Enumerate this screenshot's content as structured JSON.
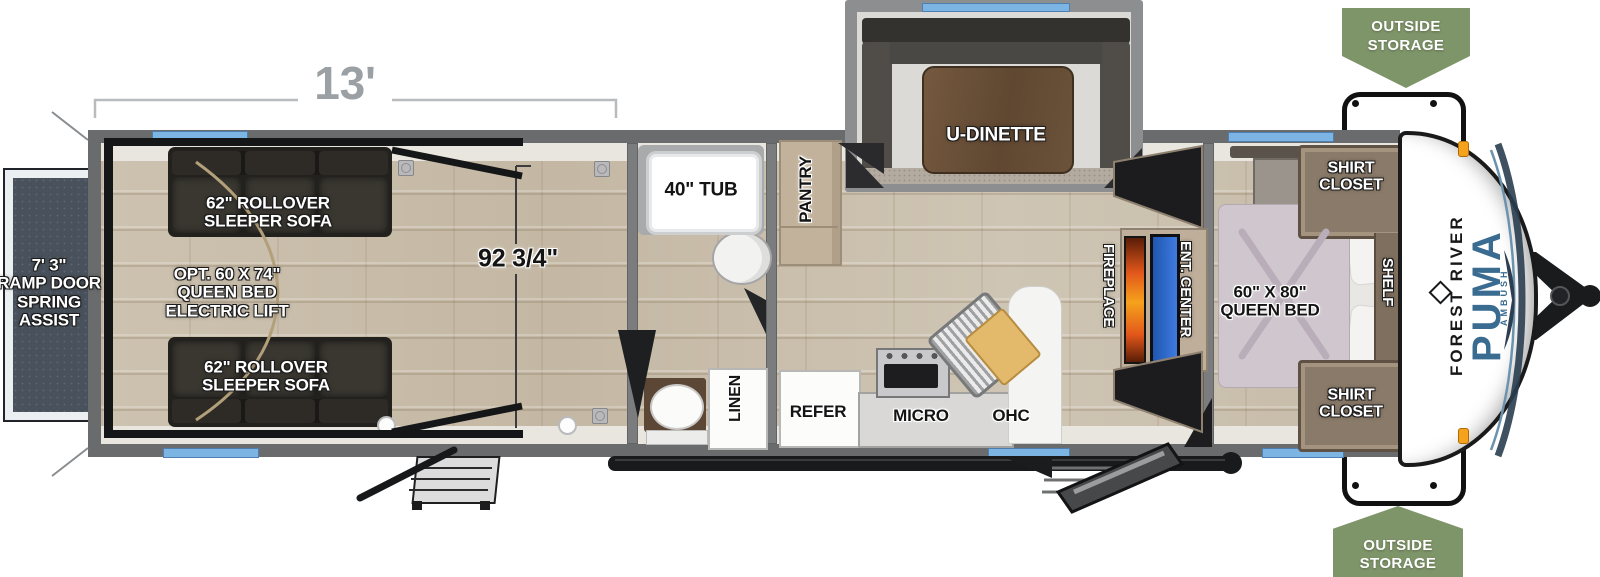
{
  "title": "Forest River Puma Ambush toy hauler floor plan",
  "dimensions": {
    "garage_length": "13'",
    "garage_interior": "92 3/4\""
  },
  "exterior": {
    "outside_storage_top": {
      "line1": "OUTSIDE",
      "line2": "STORAGE"
    },
    "outside_storage_bottom": {
      "line1": "OUTSIDE",
      "line2": "STORAGE"
    },
    "ramp_door": {
      "line1": "7' 3\"",
      "line2": "RAMP DOOR",
      "line3": "SPRING",
      "line4": "ASSIST"
    },
    "brand": {
      "manufacturer": "FOREST RIVER",
      "model": "PUMA",
      "series": "AMBUSH"
    }
  },
  "garage": {
    "sofa_top": {
      "line1": "62\" ROLLOVER",
      "line2": "SLEEPER SOFA"
    },
    "sofa_bottom": {
      "line1": "62\" ROLLOVER",
      "line2": "SLEEPER SOFA"
    },
    "opt_bed": {
      "line1": "OPT. 60 X 74\"",
      "line2": "QUEEN BED",
      "line3": "ELECTRIC LIFT"
    }
  },
  "bathroom": {
    "tub": "40\" TUB",
    "linen": "LINEN"
  },
  "kitchen": {
    "pantry": "PANTRY",
    "dinette": "U-DINETTE",
    "refer": "REFER",
    "micro": "MICRO",
    "ohc": "OHC"
  },
  "living": {
    "fireplace": "FIREPLACE",
    "ent_center": "ENT. CENTER"
  },
  "bedroom": {
    "bed": {
      "line1": "60\" X 80\"",
      "line2": "QUEEN BED"
    },
    "shirt_closet_top": {
      "line1": "SHIRT",
      "line2": "CLOSET"
    },
    "shirt_closet_bottom": {
      "line1": "SHIRT",
      "line2": "CLOSET"
    },
    "shelf": "SHELF"
  },
  "colors": {
    "banner_green": "#7E9469",
    "window_blue": "#7CB4E4",
    "puma_blue": "#3A6B91",
    "wall_gray": "#6A6B6D",
    "ramp_gray": "#49525C",
    "floor_tan": "#C9BEAC",
    "fireplace_orange": "#F07E1E",
    "tv_blue": "#2F6FD8",
    "mattress_mauve": "#CFC6CE",
    "closet_brown": "#8A7A69",
    "cabinet_tan": "#C2B29C"
  }
}
